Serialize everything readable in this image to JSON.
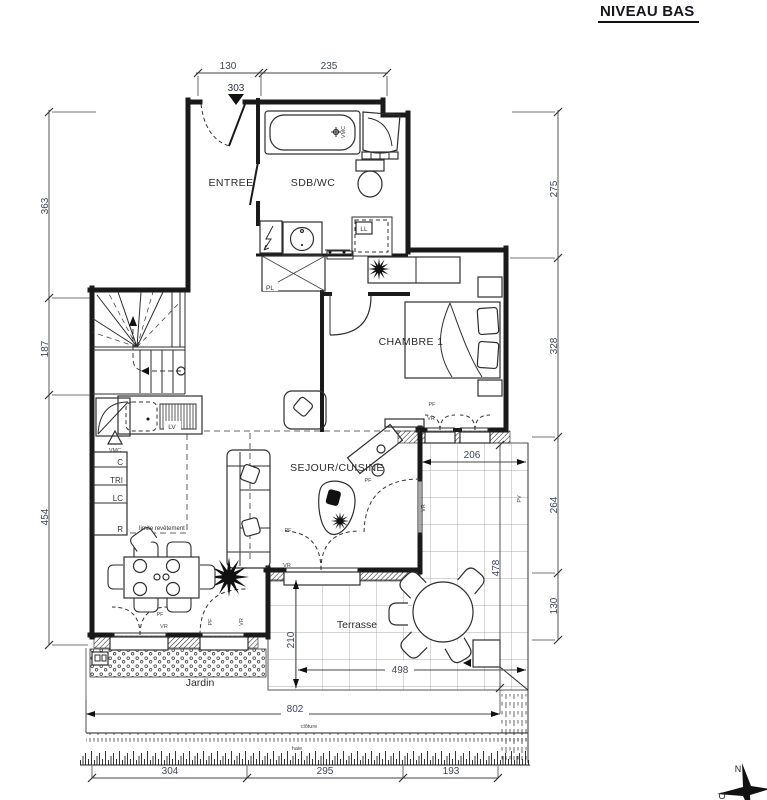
{
  "title": "NIVEAU BAS",
  "rooms": {
    "entree": "ENTREE",
    "sdb_wc": "SDB/WC",
    "chambre": "CHAMBRE 1",
    "sejour": "SEJOUR/CUISINE",
    "terrasse": "Terrasse",
    "jardin": "Jardin"
  },
  "equipment": {
    "vmc": "VMC",
    "ll": "LL",
    "lv": "LV",
    "pl": "PL",
    "cabinets": [
      "C",
      "TRI",
      "LC",
      "R"
    ]
  },
  "openings": {
    "pf": "PF",
    "vr": "VR",
    "pv": "PV"
  },
  "annotations": {
    "limite_revetement": "limite revêtement",
    "cloture": "clôture",
    "haie": "haie"
  },
  "dimensions": {
    "top": {
      "d130": "130",
      "d235": "235"
    },
    "entry_marker": "303",
    "left": {
      "d363": "363",
      "d187": "187",
      "d454": "454"
    },
    "right": {
      "d275": "275",
      "d328": "328",
      "d264": "264",
      "d130": "130"
    },
    "terrace": {
      "d206": "206",
      "d478": "478",
      "d210": "210",
      "d498": "498"
    },
    "garden": {
      "d802": "802",
      "d304": "304",
      "d295": "295",
      "d193": "193"
    }
  },
  "compass": {
    "north": "N",
    "west": "O"
  },
  "colors": {
    "line": "#1a1a1a",
    "dim_text": "#3e4660",
    "furniture": "#2e2e2e"
  }
}
